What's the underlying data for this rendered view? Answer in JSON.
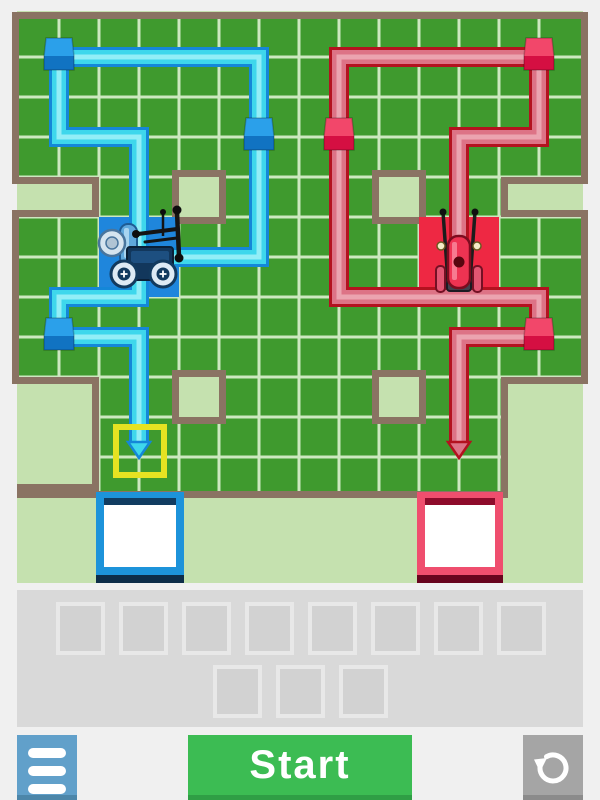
{
  "game": {
    "start_label": "Start"
  },
  "colors": {
    "page_bg": "#f0f0f0",
    "board_outside": "#c5e1af",
    "field_green": "#3f9a2e",
    "grid_line": "#cde8c0",
    "wall_brown": "#8a7363",
    "yellow_highlight": "#e6e222",
    "blue": {
      "zone": "#1f86dc",
      "path_outline": "#1487d8",
      "path_fill": "#3ed7ec",
      "path_light": "#93eef7",
      "cube_top": "#2ba0ea",
      "cube_front": "#1173c2",
      "goal_border": "#1d93da",
      "goal_dark_top": "#113c61",
      "goal_dark_bottom": "#0d2d49"
    },
    "red": {
      "zone": "#ee2843",
      "path_outline": "#b3121f",
      "path_fill": "#dd7386",
      "path_light": "#eba4b0",
      "cube_top": "#f2476a",
      "cube_front": "#d50f42",
      "goal_border": "#ef4e6e",
      "goal_dark_top": "#8e0b2b",
      "goal_dark_bottom": "#68041e"
    },
    "tray_panel": "#d9d9d9",
    "slot_fill": "#d2d2d2",
    "slot_border": "#e8e8e8",
    "menu_button": "#61a0ca",
    "menu_button_bevel": "#4c86a9",
    "start_button": "#3cbc53",
    "start_button_bevel": "#2f9e45",
    "reset_button": "#a5a5a5",
    "reset_button_bevel": "#8b8b8b"
  },
  "board": {
    "field_polygon": [
      [
        19,
        19
      ],
      [
        581,
        19
      ],
      [
        581,
        177
      ],
      [
        501,
        177
      ],
      [
        501,
        217
      ],
      [
        581,
        217
      ],
      [
        581,
        377
      ],
      [
        501,
        377
      ],
      [
        501,
        491
      ],
      [
        99,
        491
      ],
      [
        99,
        377
      ],
      [
        19,
        377
      ],
      [
        19,
        217
      ],
      [
        99,
        217
      ],
      [
        99,
        177
      ],
      [
        19,
        177
      ]
    ],
    "extra_wall_segments": [
      {
        "x": 17,
        "y": 484,
        "w": 82,
        "h": 14
      }
    ],
    "grid": {
      "x_lines": [
        59,
        99,
        139,
        179,
        219,
        259,
        299,
        339,
        379,
        419,
        459,
        499,
        539
      ],
      "y_lines": [
        57,
        97,
        137,
        177,
        217,
        257,
        297,
        337,
        377,
        417,
        457
      ]
    },
    "obstacles": [
      {
        "x": 179,
        "y": 177
      },
      {
        "x": 379,
        "y": 177
      },
      {
        "x": 179,
        "y": 377
      },
      {
        "x": 379,
        "y": 377
      }
    ],
    "zones": [
      {
        "team": "blue",
        "x": 99,
        "y": 217,
        "w": 80,
        "h": 80
      },
      {
        "team": "red",
        "x": 419,
        "y": 217,
        "w": 80,
        "h": 80
      }
    ],
    "routes": [
      {
        "team": "blue",
        "points": [
          [
            139,
            257
          ],
          [
            139,
            137
          ],
          [
            59,
            137
          ],
          [
            59,
            57
          ],
          [
            259,
            57
          ],
          [
            259,
            257
          ],
          [
            139,
            257
          ],
          [
            139,
            297
          ],
          [
            59,
            297
          ],
          [
            59,
            337
          ],
          [
            139,
            337
          ],
          [
            139,
            444
          ]
        ],
        "arrow_tip": [
          139,
          458
        ]
      },
      {
        "team": "red",
        "points": [
          [
            459,
            257
          ],
          [
            459,
            137
          ],
          [
            539,
            137
          ],
          [
            539,
            57
          ],
          [
            339,
            57
          ],
          [
            339,
            297
          ],
          [
            539,
            297
          ],
          [
            539,
            337
          ],
          [
            459,
            337
          ],
          [
            459,
            444
          ]
        ],
        "arrow_tip": [
          459,
          458
        ]
      }
    ],
    "cubes": [
      {
        "team": "blue",
        "x": 59,
        "y": 57
      },
      {
        "team": "blue",
        "x": 259,
        "y": 137
      },
      {
        "team": "blue",
        "x": 59,
        "y": 337
      },
      {
        "team": "red",
        "x": 539,
        "y": 57
      },
      {
        "team": "red",
        "x": 339,
        "y": 137
      },
      {
        "team": "red",
        "x": 539,
        "y": 337
      }
    ],
    "target_highlight": {
      "team": "blue",
      "x": 116,
      "y": 427,
      "size": 48
    },
    "goal_boxes": [
      {
        "team": "blue",
        "x": 96,
        "y": 492,
        "w": 88,
        "h": 91
      },
      {
        "team": "red",
        "x": 417,
        "y": 492,
        "w": 86,
        "h": 91
      }
    ],
    "vehicles": [
      {
        "team": "blue",
        "cx": 139,
        "cy": 257
      },
      {
        "team": "red",
        "cx": 459,
        "cy": 257
      }
    ]
  },
  "tray": {
    "rows": [
      {
        "slots": 8
      },
      {
        "slots": 3
      }
    ]
  }
}
